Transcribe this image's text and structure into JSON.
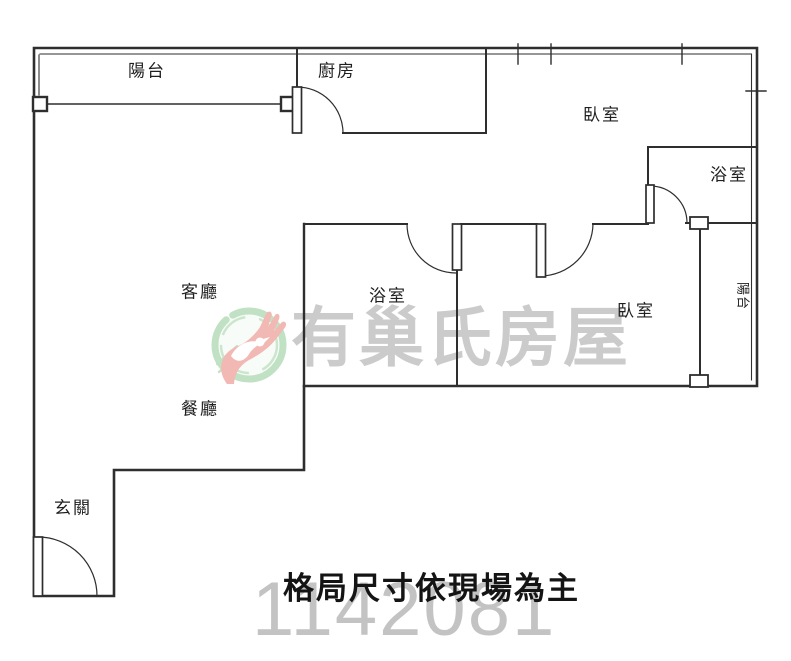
{
  "floorplan": {
    "rooms": [
      {
        "id": "balcony-top",
        "label": "陽台"
      },
      {
        "id": "kitchen",
        "label": "廚房"
      },
      {
        "id": "bedroom-top",
        "label": "臥室"
      },
      {
        "id": "bathroom-top",
        "label": "浴室"
      },
      {
        "id": "living-room",
        "label": "客廳"
      },
      {
        "id": "bathroom-mid",
        "label": "浴室"
      },
      {
        "id": "bedroom-right",
        "label": "臥室"
      },
      {
        "id": "balcony-right",
        "label": "陽台"
      },
      {
        "id": "dining-room",
        "label": "餐廳"
      },
      {
        "id": "entry",
        "label": "玄關"
      }
    ],
    "note": "格局尺寸依現場為主",
    "watermark": {
      "brand": "有巢氏房屋",
      "number": "1142081",
      "logo": "uhouse-hand-dove-logo"
    },
    "colors": {
      "wall": "#2e2e2e",
      "label_text": "#1f1f1f",
      "watermark_gray": "#cbcbcb",
      "number_gray": "#c3c3c3",
      "logo_green": "#8cc996",
      "logo_red": "#eb8e86"
    }
  }
}
